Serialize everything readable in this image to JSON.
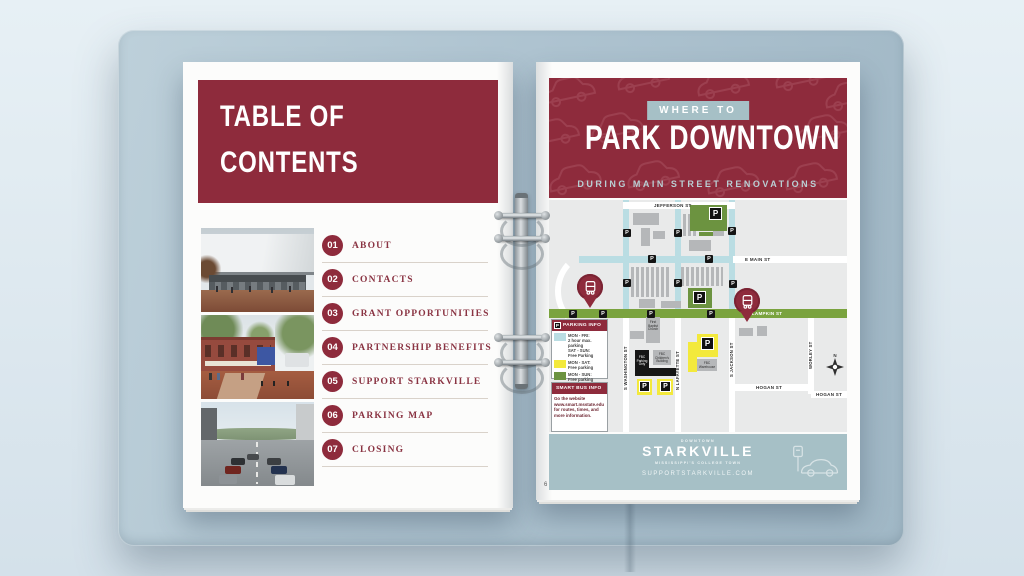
{
  "left_page": {
    "header": {
      "line1": "TABLE OF",
      "line2": "CONTENTS"
    },
    "toc_items": [
      {
        "num": "01",
        "label": "ABOUT"
      },
      {
        "num": "02",
        "label": "CONTACTS"
      },
      {
        "num": "03",
        "label": "GRANT OPPORTUNITIES"
      },
      {
        "num": "04",
        "label": "PARTNERSHIP BENEFITS"
      },
      {
        "num": "05",
        "label": "SUPPORT STARKVILLE"
      },
      {
        "num": "06",
        "label": "PARKING MAP"
      },
      {
        "num": "07",
        "label": "CLOSING"
      }
    ],
    "photos": [
      "downtown-building-rendering",
      "brick-storefront-streetscape",
      "main-street-with-parked-cars"
    ]
  },
  "right_page": {
    "banner": {
      "eyebrow": "WHERE TO",
      "title": "PARK DOWNTOWN",
      "subtitle": "DURING MAIN STREET RENOVATIONS"
    },
    "map": {
      "p_glyph": "P",
      "compass_n": "N",
      "streets": {
        "jefferson": "JEFFERSON ST",
        "e_main": "E MAIN ST",
        "e_lampkin": "E LAMPKIN ST",
        "hogan": "HOGAN ST",
        "hogan2": "HOGAN ST",
        "s_washington": "S WASHINGTON ST",
        "n_lafayette": "N LAFAYETTE ST",
        "s_jackson": "S JACKSON ST",
        "worley": "WORLEY ST"
      },
      "buildings": {
        "first_baptist": "First Baptist Church",
        "fbc_parking": "FBC Parking Only",
        "fbc_childrens": "FBC Children's Building",
        "fbc_warehouse": "FBC Warehouse"
      },
      "legend": {
        "title": "PARKING INFO",
        "rows": [
          {
            "hex": "#badde3",
            "lines": [
              "MON - FRI:",
              "2 hour max. parking",
              "SAT - SUN:",
              "Free Parking"
            ]
          },
          {
            "hex": "#f3e93c",
            "lines": [
              "MON - SAT:",
              "Free parking"
            ]
          },
          {
            "hex": "#6c9340",
            "lines": [
              "MON - SUN:",
              "Free parking"
            ]
          }
        ]
      },
      "smart_bus": {
        "title": "SMART BUS INFO",
        "lines": [
          "Go the website",
          "www.smart.msstate.edu",
          "for routes, times, and",
          "more information."
        ]
      }
    },
    "footer": {
      "arc_text": "DOWNTOWN",
      "logo": "STARKVILLE",
      "tagline": "MISSISSIPPI'S COLLEGE TOWN",
      "website": "SUPPORTSTARKVILLE.COM",
      "page_number": "6"
    }
  },
  "colors": {
    "maroon": "#8e2b3c",
    "steel_blue": "#a6c0c6",
    "map_street_blue": "#badde3",
    "map_green_street": "#7aa33e",
    "lot_yellow": "#f3e93c",
    "lot_green": "#6c9340",
    "binder_blue": "#aec3d0"
  }
}
